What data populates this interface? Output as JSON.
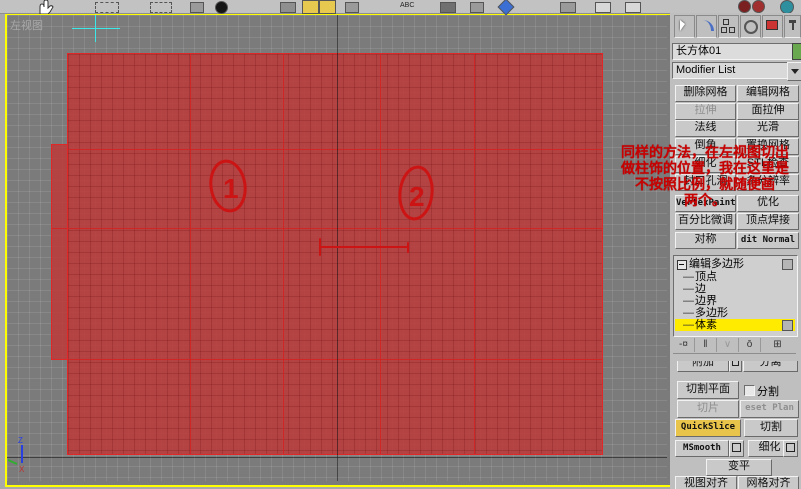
{
  "window": {
    "spellcheck_label": "ABC",
    "toolbar_icons": [
      "dotted-select-region-icon",
      "lasso-select-icon",
      "grid-icon",
      "black-circle-icon",
      "arc-rotate-icon",
      "snap-toggle-icon",
      "angle-snap-icon",
      "percent-snap-icon",
      "spellcheck-icon",
      "mirror-icon",
      "array-icon",
      "align-icon",
      "layer-icon",
      "curve-editor-icon",
      "schematic-view-icon",
      "material-editor-sphere1-icon",
      "material-editor-sphere2-icon",
      "render-setup-icon"
    ]
  },
  "viewport": {
    "label": "左视图",
    "annotation_lines": [
      "同样的方法，在左视图切出",
      "做柱饰的位置，我在这里是",
      "不按照比例，就随便画",
      "两个。"
    ],
    "circle_labels": [
      "1",
      "2"
    ],
    "axis_labels": {
      "z": "Z",
      "x": "X"
    }
  },
  "panel": {
    "tabs": [
      "create",
      "modify",
      "hierarchy",
      "motion",
      "display",
      "utilities"
    ],
    "object_name": "长方体01",
    "modifier_list_label": "Modifier List",
    "modifier_buttons": [
      {
        "left": "删除网格",
        "right": "编辑网格"
      },
      {
        "left": "拉伸",
        "right": "面拉伸"
      },
      {
        "left": "法线",
        "right": "光滑"
      },
      {
        "left": "倒角",
        "right": "置换网格"
      },
      {
        "left": "细化",
        "right": "STL检查"
      },
      {
        "left": "封口孔洞",
        "right": "多分辨率"
      },
      {
        "left": "VertexPaint",
        "right": "优化"
      },
      {
        "left": "百分比微调",
        "right": "顶点焊接"
      },
      {
        "left": "对称",
        "right": "dit Normal"
      }
    ],
    "stack": {
      "tree_prefix": "—",
      "expand_glyph": "日",
      "root": "编辑多边形",
      "items": [
        "顶点",
        "边",
        "边界",
        "多边形",
        "体素"
      ],
      "selected": "体素"
    },
    "edit_geometry": {
      "attach": "附加",
      "detach": "分离",
      "slice_plane": "切割平面",
      "split": "分割",
      "slice": "切片",
      "reset_plane": "eset Plan",
      "quickslice": "QuickSlice",
      "cut": "切割",
      "msmooth": "MSmooth",
      "tessellate": "细化",
      "make_planar": "变平",
      "view_align": "视图对齐",
      "grid_align": "网格对齐"
    }
  },
  "colors": {
    "viewport_border": "#ffff00",
    "mesh_fill": "#bb3a3a",
    "mesh_edge": "#e02828",
    "annotation_red": "#c80000",
    "quickslice_highlight": "#e9c44a",
    "selected_stack_row": "#ffeb00",
    "object_color_swatch": "#6aa84f",
    "crosshair_cyan": "#3de8e8"
  }
}
